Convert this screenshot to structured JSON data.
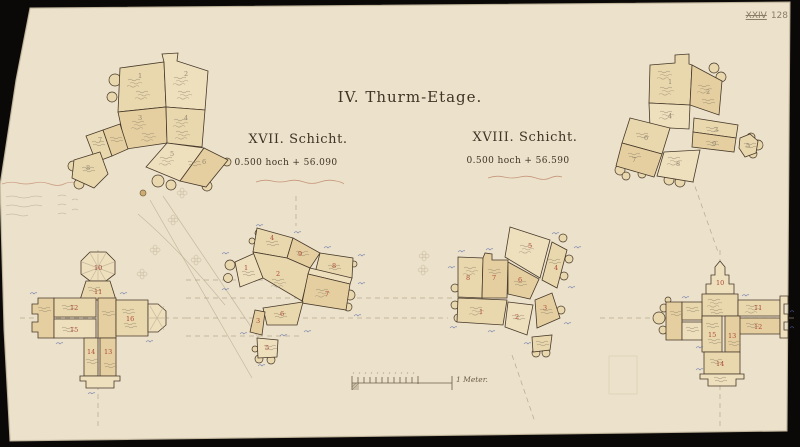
{
  "document": {
    "archive_note": {
      "series": "XXIV",
      "number": "128"
    },
    "title": "IV. Thurm-Etage.",
    "sections": [
      {
        "heading": "XVII. Schicht.",
        "elevation": "0.500 hoch + 56.090"
      },
      {
        "heading": "XVIII. Schicht.",
        "elevation": "0.500 hoch + 56.590"
      }
    ],
    "scale_label": "1 Meter.",
    "colors": {
      "paper": "#ece1ca",
      "ink": "#3f3425",
      "stone": "#e9d7ad",
      "red_ink": "#a63c2a",
      "blue_ink": "#5767a9",
      "pencil": "#9a8d74"
    },
    "clusters": {
      "top_left": {
        "stones": [
          "1",
          "2",
          "3",
          "4",
          "5",
          "6",
          "7",
          "8"
        ]
      },
      "top_right": {
        "stones": [
          "1",
          "2",
          "3",
          "4",
          "5",
          "6",
          "7",
          "8",
          "9"
        ]
      },
      "mid_left": {
        "stones": [
          "1",
          "2",
          "3",
          "4",
          "5",
          "6",
          "7",
          "8",
          "9"
        ]
      },
      "mid_right": {
        "stones": [
          "1",
          "2",
          "3",
          "4",
          "5",
          "6",
          "7",
          "8"
        ]
      },
      "cross_left": {
        "stones": [
          "10",
          "11",
          "12",
          "13",
          "14",
          "15",
          "16"
        ]
      },
      "cross_right": {
        "stones": [
          "10",
          "11",
          "12",
          "13",
          "14",
          "15"
        ]
      }
    }
  }
}
